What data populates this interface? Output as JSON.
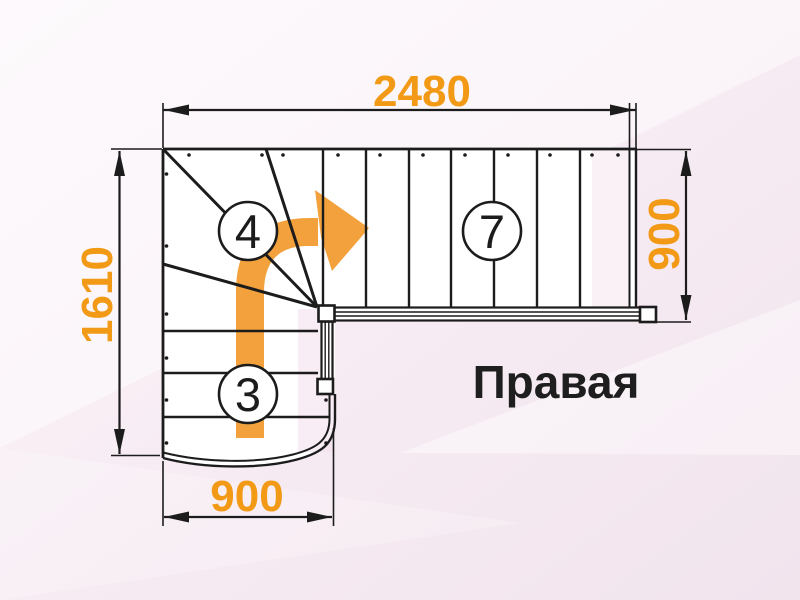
{
  "title": {
    "text": "Правая"
  },
  "dimensions": {
    "top": {
      "value": "2480"
    },
    "left": {
      "value": "1610"
    },
    "right": {
      "value": "900"
    },
    "bottom": {
      "value": "900"
    }
  },
  "flights": {
    "winder_steps": "4",
    "upper_steps": "7",
    "lower_steps": "3"
  },
  "colors": {
    "accent_orange": "#F29A16",
    "arrow_orange": "#F2A13C",
    "line_black": "#1c1c1c",
    "background_pink": "#f4e8f0",
    "stair_fill": "#ffffff"
  },
  "icons": {
    "direction_arrow": "curved-right-arrow"
  }
}
